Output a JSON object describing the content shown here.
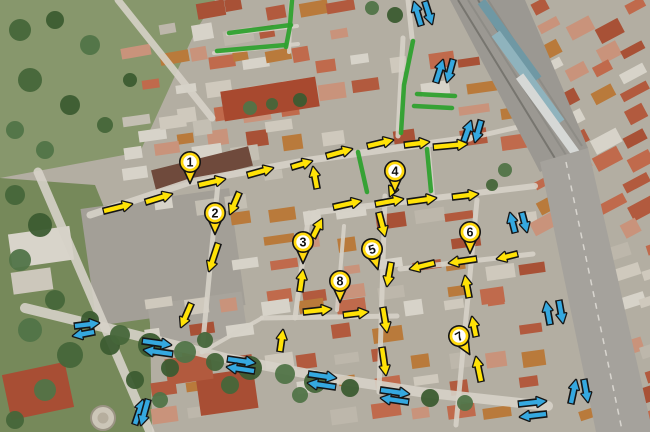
{
  "map_annotations": {
    "colors": {
      "marker_fill": "#FFD90F",
      "marker_stroke": "#141414",
      "marker_inner": "#FFFFFF",
      "marker_number": "#111111",
      "arrow_yellow": "#FFE207",
      "arrow_blue": "#35A8DF",
      "arrow_outline": "#151515",
      "closed_street_green": "#2FA12F"
    },
    "markers": [
      {
        "label": "1",
        "x": 190,
        "y": 162,
        "rot": 0
      },
      {
        "label": "2",
        "x": 215,
        "y": 213,
        "rot": 0
      },
      {
        "label": "3",
        "x": 303,
        "y": 242,
        "rot": 0
      },
      {
        "label": "4",
        "x": 395,
        "y": 171,
        "rot": 0
      },
      {
        "label": "5",
        "x": 372,
        "y": 249,
        "rot": -16
      },
      {
        "label": "6",
        "x": 470,
        "y": 232,
        "rot": 0
      },
      {
        "label": "7",
        "x": 459,
        "y": 336,
        "rot": -30
      },
      {
        "label": "8",
        "x": 340,
        "y": 281,
        "rot": 0
      }
    ],
    "yellow_arrows": [
      [
        104,
        211,
        132,
        204
      ],
      [
        146,
        202,
        172,
        194
      ],
      [
        199,
        185,
        225,
        179
      ],
      [
        248,
        175,
        273,
        168
      ],
      [
        292,
        167,
        312,
        161
      ],
      [
        327,
        156,
        352,
        149
      ],
      [
        368,
        146,
        393,
        140
      ],
      [
        405,
        145,
        429,
        142
      ],
      [
        434,
        147,
        467,
        144
      ],
      [
        239,
        193,
        230,
        214
      ],
      [
        317,
        188,
        313,
        167
      ],
      [
        397,
        180,
        390,
        196
      ],
      [
        334,
        207,
        361,
        201
      ],
      [
        376,
        204,
        403,
        199
      ],
      [
        408,
        202,
        436,
        198
      ],
      [
        453,
        197,
        478,
        194
      ],
      [
        218,
        244,
        209,
        271
      ],
      [
        191,
        304,
        181,
        327
      ],
      [
        300,
        291,
        303,
        270
      ],
      [
        313,
        237,
        322,
        219
      ],
      [
        379,
        213,
        385,
        236
      ],
      [
        391,
        263,
        387,
        286
      ],
      [
        434,
        263,
        410,
        269
      ],
      [
        476,
        259,
        449,
        263
      ],
      [
        517,
        254,
        497,
        259
      ],
      [
        469,
        297,
        465,
        276
      ],
      [
        476,
        336,
        472,
        317
      ],
      [
        481,
        381,
        476,
        357
      ],
      [
        383,
        308,
        387,
        332
      ],
      [
        382,
        348,
        386,
        375
      ],
      [
        304,
        312,
        331,
        309
      ],
      [
        344,
        315,
        368,
        312
      ],
      [
        280,
        351,
        283,
        330
      ]
    ],
    "blue_arrows": [
      [
        421,
        25,
        414,
        2
      ],
      [
        425,
        2,
        432,
        24
      ],
      [
        436,
        82,
        443,
        60
      ],
      [
        453,
        60,
        447,
        82
      ],
      [
        464,
        141,
        471,
        121
      ],
      [
        481,
        121,
        475,
        142
      ],
      [
        515,
        232,
        510,
        213
      ],
      [
        522,
        213,
        527,
        232
      ],
      [
        550,
        324,
        546,
        302
      ],
      [
        559,
        301,
        563,
        323
      ],
      [
        571,
        403,
        576,
        380
      ],
      [
        584,
        380,
        588,
        402
      ],
      [
        519,
        404,
        546,
        401
      ],
      [
        546,
        414,
        520,
        417
      ],
      [
        75,
        326,
        99,
        323
      ],
      [
        94,
        332,
        73,
        336
      ],
      [
        143,
        341,
        171,
        345
      ],
      [
        172,
        354,
        144,
        350
      ],
      [
        135,
        424,
        143,
        400
      ],
      [
        148,
        400,
        141,
        425
      ],
      [
        228,
        359,
        255,
        363
      ],
      [
        254,
        371,
        227,
        367
      ],
      [
        309,
        374,
        336,
        378
      ],
      [
        335,
        387,
        308,
        383
      ],
      [
        381,
        390,
        409,
        394
      ],
      [
        408,
        402,
        381,
        398
      ]
    ],
    "green_segments": [
      [
        [
          292,
          0
        ],
        [
          290,
          25
        ]
      ],
      [
        [
          229,
          33
        ],
        [
          291,
          25
        ]
      ],
      [
        [
          217,
          51
        ],
        [
          286,
          45
        ]
      ],
      [
        [
          290,
          26
        ],
        [
          286,
          47
        ]
      ],
      [
        [
          413,
          41
        ],
        [
          404,
          85
        ],
        [
          401,
          133
        ]
      ],
      [
        [
          358,
          152
        ],
        [
          367,
          192
        ]
      ],
      [
        [
          427,
          149
        ],
        [
          431,
          191
        ]
      ],
      [
        [
          417,
          94
        ],
        [
          455,
          96
        ]
      ],
      [
        [
          414,
          106
        ],
        [
          452,
          108
        ]
      ]
    ]
  }
}
